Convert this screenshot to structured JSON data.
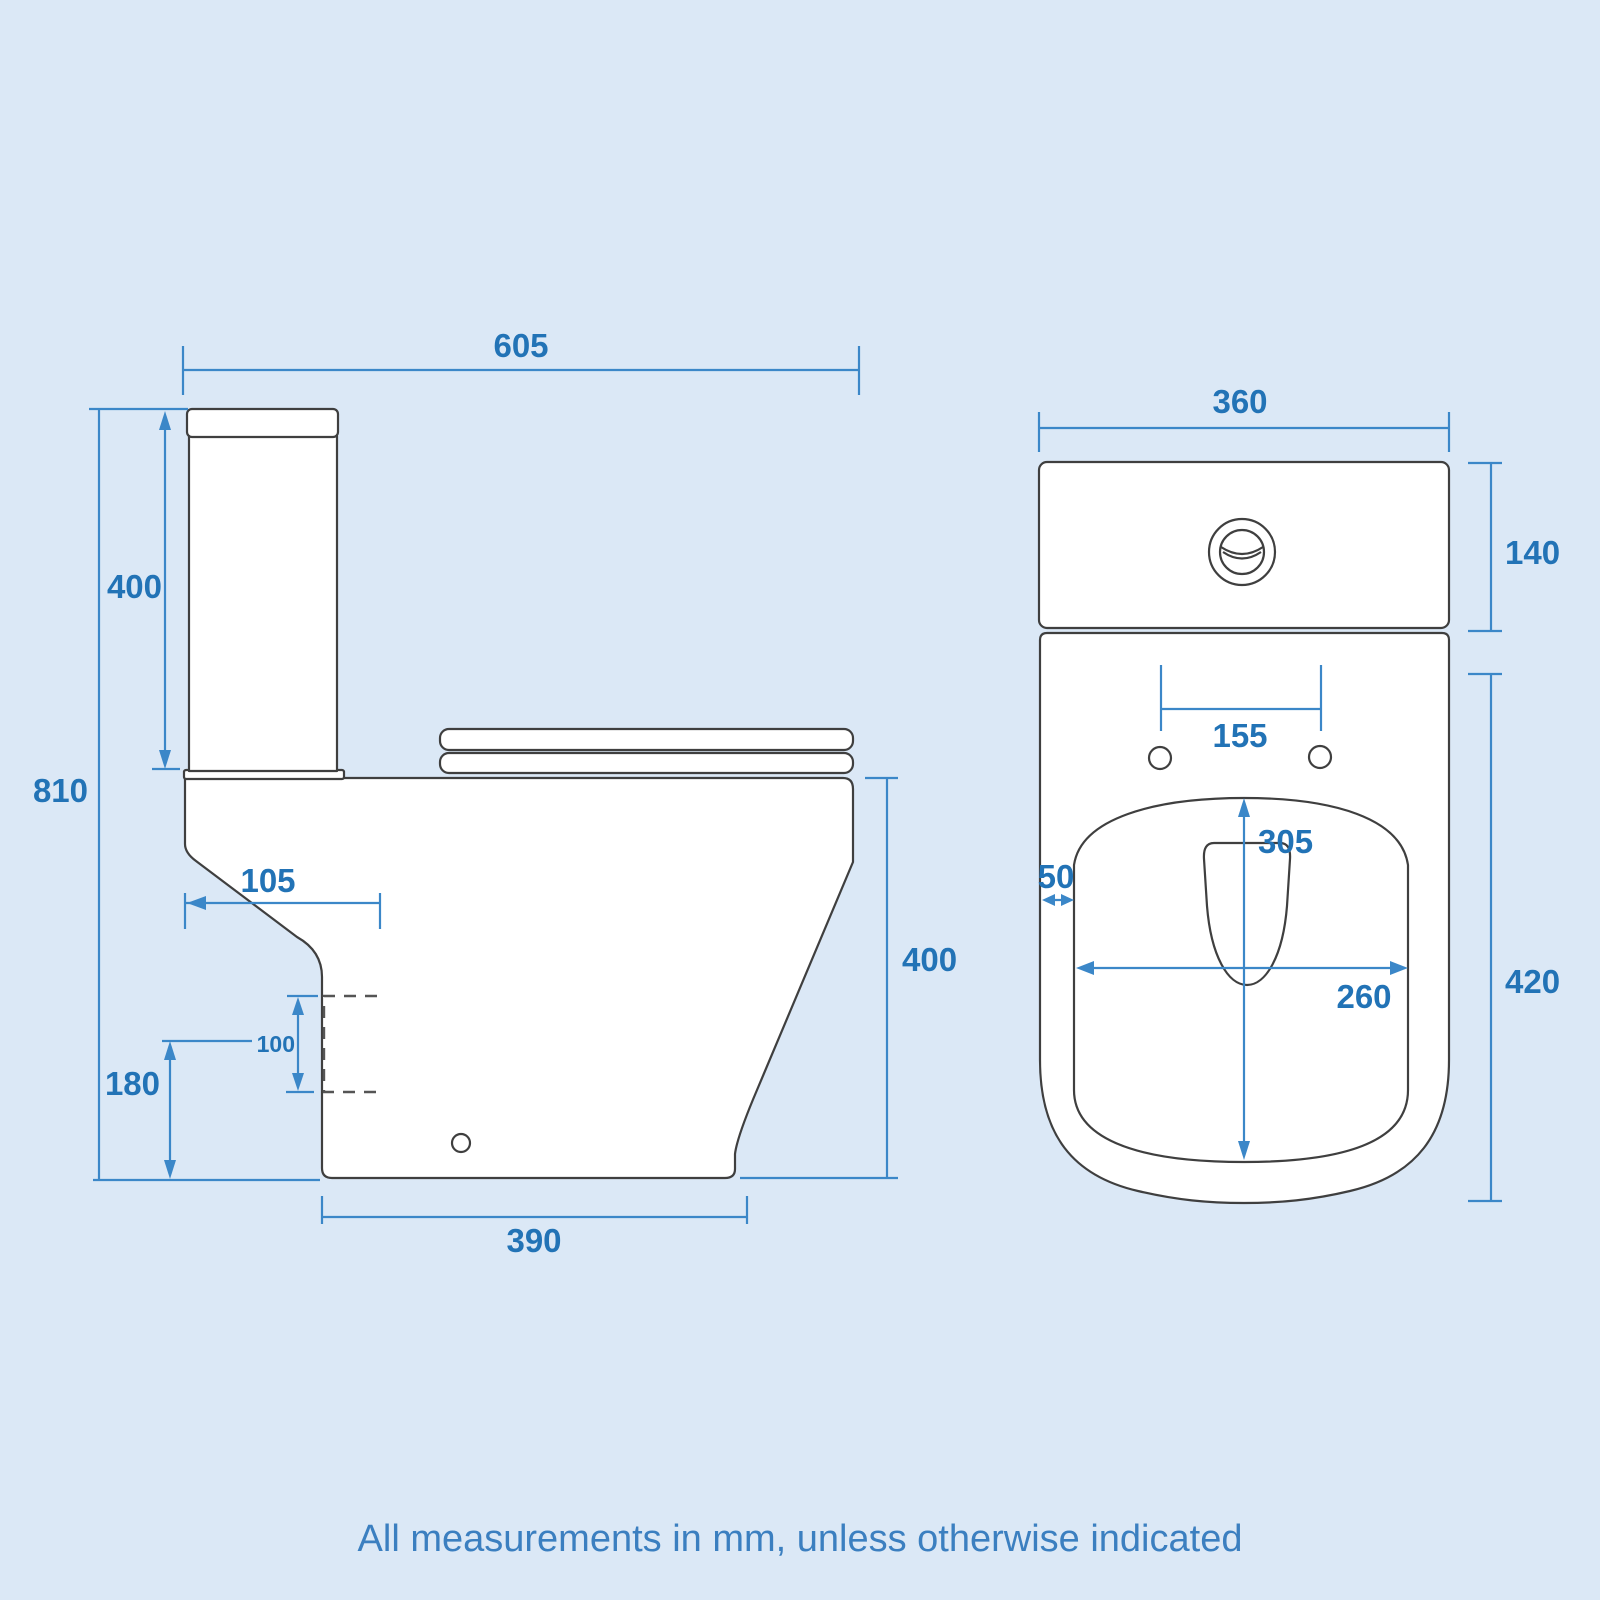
{
  "note": "All measurements in mm, unless otherwise indicated",
  "colors": {
    "background": "#dbe8f6",
    "line": "#3f3f3f",
    "dimension": "#3b87c8",
    "label": "#2273b6",
    "note": "#3b7fc0",
    "fixture": "#ffffff"
  },
  "side_view": {
    "name": "Close coupled toilet - side elevation",
    "dimensions": {
      "overall_width": "605",
      "cistern_height": "400",
      "overall_height": "810",
      "trap_setback": "105",
      "outlet_size": "100",
      "outlet_height": "180",
      "pan_height": "400",
      "base_depth": "390"
    }
  },
  "front_view": {
    "name": "Close coupled toilet - front elevation",
    "dimensions": {
      "overall_width": "360",
      "cistern_height": "140",
      "seat_bolt_spacing": "155",
      "bowl_depth": "305",
      "rim_thickness": "50",
      "bowl_width": "260",
      "pan_height": "420"
    }
  }
}
